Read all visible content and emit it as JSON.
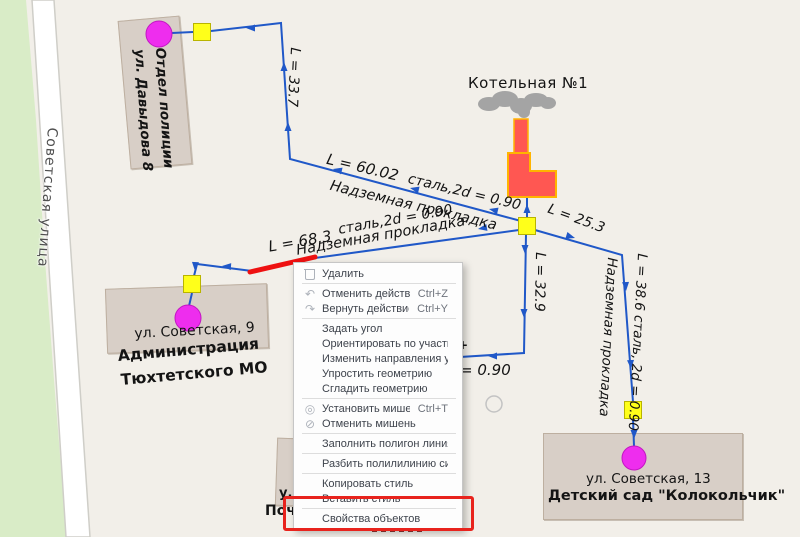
{
  "map": {
    "street": "Советская улица",
    "boiler_label": "Котельная №1",
    "buildings": {
      "police": {
        "line1": "Отдел полиции",
        "line2": "ул. Давыдова 8"
      },
      "admin": {
        "address": "ул. Советская, 9",
        "name1": "Администрация",
        "name2": "Тюхтетского МО"
      },
      "kindergarten": {
        "address": "ул. Советская, 13",
        "name": "Детский сад \"Колокольчик\""
      },
      "post": {
        "fragment1": "у.",
        "fragment2": "Поч"
      }
    },
    "pipe_labels": {
      "p1_len": "L = 33.7",
      "p2_len": "L = 60.02",
      "p2_spec": "сталь,2d = 0.90",
      "p2_type": "Надземная прокладка",
      "p3_len": "L = 68.3",
      "p3_spec": "сталь,2d = 0.90",
      "p3_type": "Надземная прокладка",
      "p4_len": "L = 25.3",
      "p5_len": "L = 32.9",
      "p6_len": "L = 38.6 сталь, 2d = 0.90",
      "p6_type": "Надземная прокладка",
      "p7_spec": "= 0.90",
      "p7_plus": "+"
    },
    "colors": {
      "pipe_blue": "#2058c8",
      "selected_pipe_red": "#ee1111",
      "node_yellow": "#ffff1a",
      "source_magenta": "#ee2dee",
      "boiler_red": "#ff5752",
      "boiler_outline": "#ffb400",
      "background": "#f2efe9",
      "highlight_red": "#e8231d"
    }
  },
  "context_menu": {
    "icon_glyphs": {
      "undo-icon": "↶",
      "redo-icon": "↷",
      "target-set-icon": "◎",
      "target-clear-icon": "⊘"
    },
    "items": [
      {
        "label": "Удалить",
        "icon": "trash-icon"
      },
      {
        "type": "separator"
      },
      {
        "label": "Отменить действие",
        "shortcut": "Ctrl+Z",
        "icon": "undo-icon"
      },
      {
        "label": "Вернуть действие",
        "shortcut": "Ctrl+Y",
        "icon": "redo-icon"
      },
      {
        "type": "separator"
      },
      {
        "label": "Задать угол"
      },
      {
        "label": "Ориентировать по участкам"
      },
      {
        "label": "Изменить направления участков"
      },
      {
        "label": "Упростить геометрию"
      },
      {
        "label": "Сгладить геометрию"
      },
      {
        "type": "separator"
      },
      {
        "label": "Установить мишень",
        "shortcut": "Ctrl+T",
        "icon": "target-set-icon"
      },
      {
        "label": "Отменить мишень",
        "icon": "target-clear-icon"
      },
      {
        "type": "separator"
      },
      {
        "label": "Заполнить полигон линиями"
      },
      {
        "type": "separator"
      },
      {
        "label": "Разбить полилилинию символами"
      },
      {
        "type": "separator"
      },
      {
        "label": "Копировать стиль"
      },
      {
        "label": "Вставить стиль"
      },
      {
        "type": "separator"
      },
      {
        "label": "Свойства объектов",
        "highlighted": true
      }
    ]
  }
}
